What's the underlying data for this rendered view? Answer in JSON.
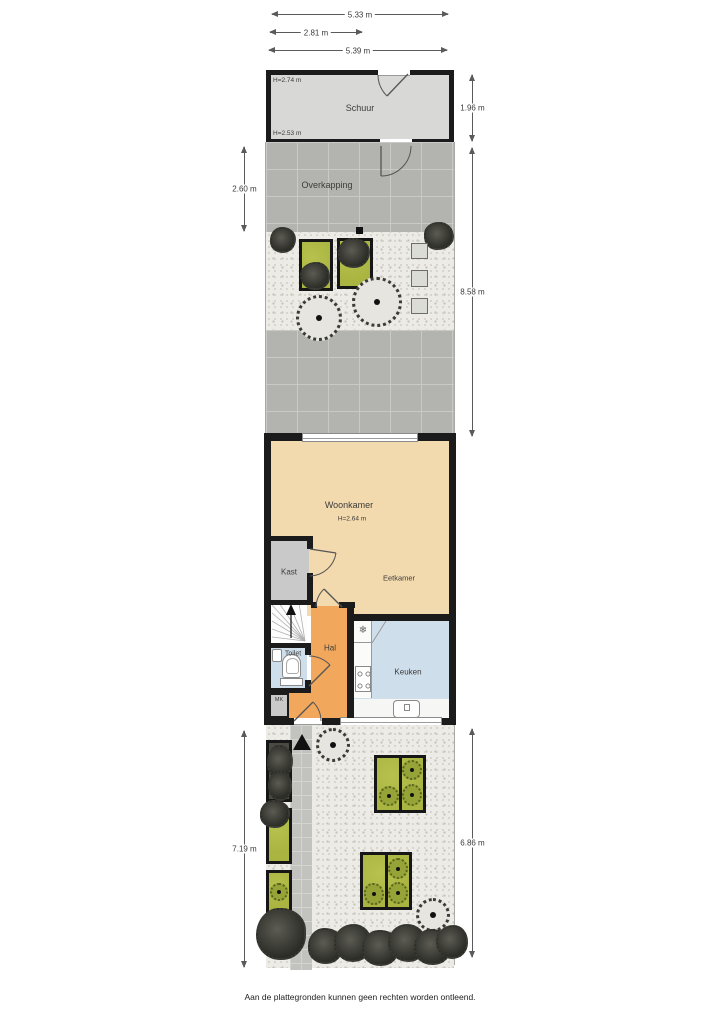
{
  "dimensions": {
    "top": [
      {
        "id": "shed-width",
        "label": "5.33 m"
      },
      {
        "id": "inner-width",
        "label": "2.81 m"
      },
      {
        "id": "plot-width",
        "label": "5.39 m"
      }
    ],
    "sides": [
      {
        "id": "shed-depth",
        "label": "1.96 m"
      },
      {
        "id": "overkapping-depth",
        "label": "2.60 m"
      },
      {
        "id": "back-garden-depth",
        "label": "8.58 m"
      },
      {
        "id": "front-garden-depth-left",
        "label": "7.19 m"
      },
      {
        "id": "front-garden-depth-right",
        "label": "6.86 m"
      }
    ]
  },
  "rooms": {
    "schuur": {
      "name": "Schuur",
      "height_front": "H=2.74 m",
      "height_back": "H=2.53 m"
    },
    "overkapping": {
      "name": "Overkapping"
    },
    "woonkamer": {
      "name": "Woonkamer",
      "height": "H=2.64 m"
    },
    "eetkamer": {
      "name": "Eetkamer"
    },
    "kast": {
      "name": "Kast"
    },
    "hal": {
      "name": "Hal"
    },
    "toilet": {
      "name": "Toilet"
    },
    "keuken": {
      "name": "Keuken"
    },
    "meterkast": {
      "name": "MK"
    }
  },
  "symbols": {
    "freezer": "❄"
  },
  "footer": {
    "disclaimer": "Aan de plattegronden kunnen geen rechten worden ontleend."
  },
  "colors": {
    "wall": "#1b1b1b",
    "living_floor": "#f3d9ae",
    "hall_floor": "#f2a85c",
    "wet_floor": "#cfdeeb",
    "closet_floor": "#c9c9c9",
    "shed_floor": "#d8d8d6",
    "paving": "#b3b3b0",
    "gravel": "#ecebe6",
    "planter_green": "#a9b441",
    "foliage": "#3a3a34"
  }
}
